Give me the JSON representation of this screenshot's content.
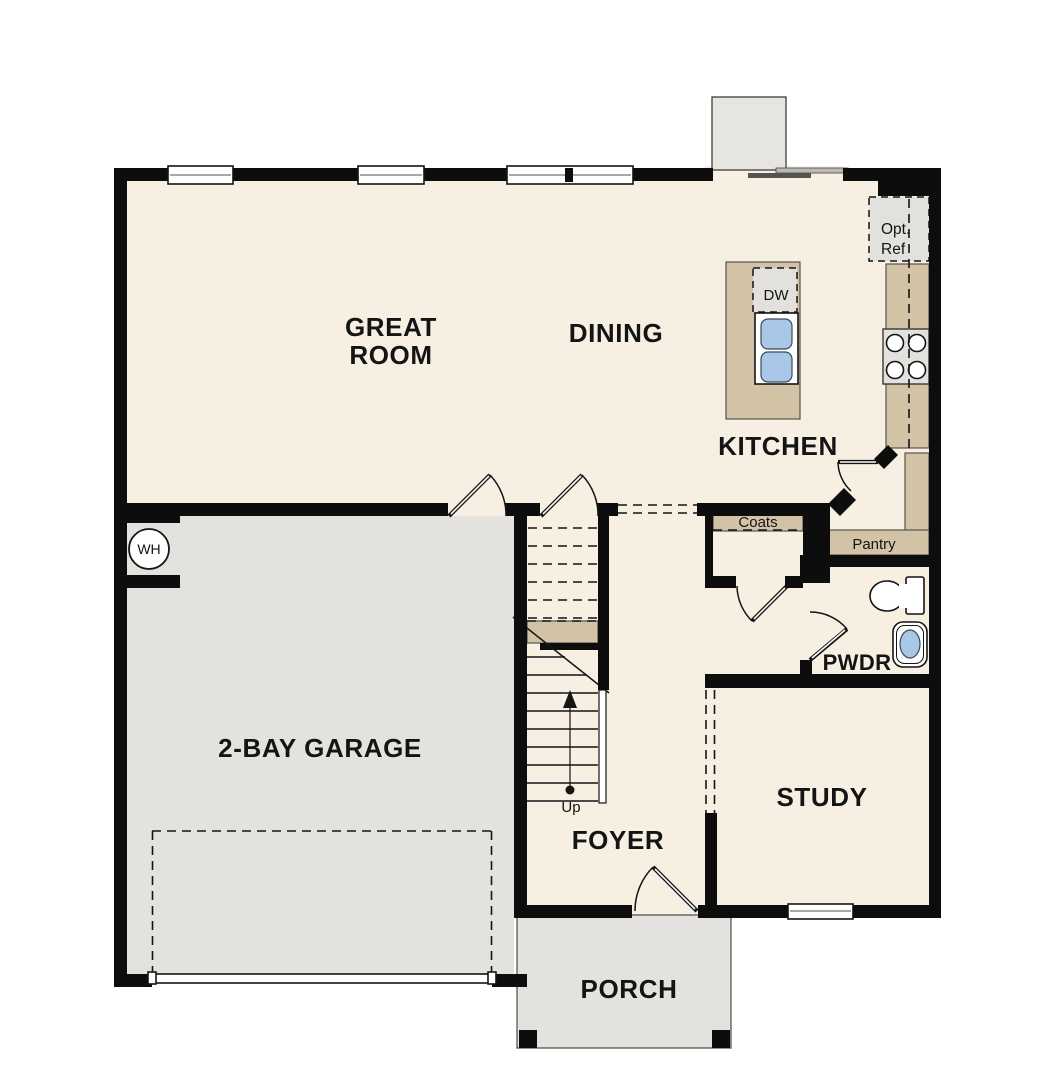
{
  "plan": {
    "title": "first-floor-plan",
    "rooms": {
      "great_room": {
        "line1": "GREAT",
        "line2": "ROOM"
      },
      "dining": {
        "label": "DINING"
      },
      "kitchen": {
        "label": "KITCHEN"
      },
      "garage": {
        "label": "2-BAY GARAGE"
      },
      "foyer": {
        "label": "FOYER"
      },
      "study": {
        "label": "STUDY"
      },
      "powder_room": {
        "label": "PWDR"
      },
      "porch": {
        "label": "PORCH"
      }
    },
    "annotations": {
      "coats_closet": "Coats",
      "pantry": "Pantry",
      "dishwasher": "DW",
      "optional_refrigerator": {
        "line1": "Opt.",
        "line2": "Ref"
      },
      "water_heater": "WH",
      "stairs_direction": "Up"
    },
    "colors": {
      "floor_cream": "#f6efe2",
      "garage_porch_gray": "#e4e2de",
      "wall_black": "#0d0d0d",
      "cabinet_tan": "#d2c3a6",
      "appliance_gray": "#e2e1de",
      "sink_blue": "#a9c7e6"
    }
  }
}
